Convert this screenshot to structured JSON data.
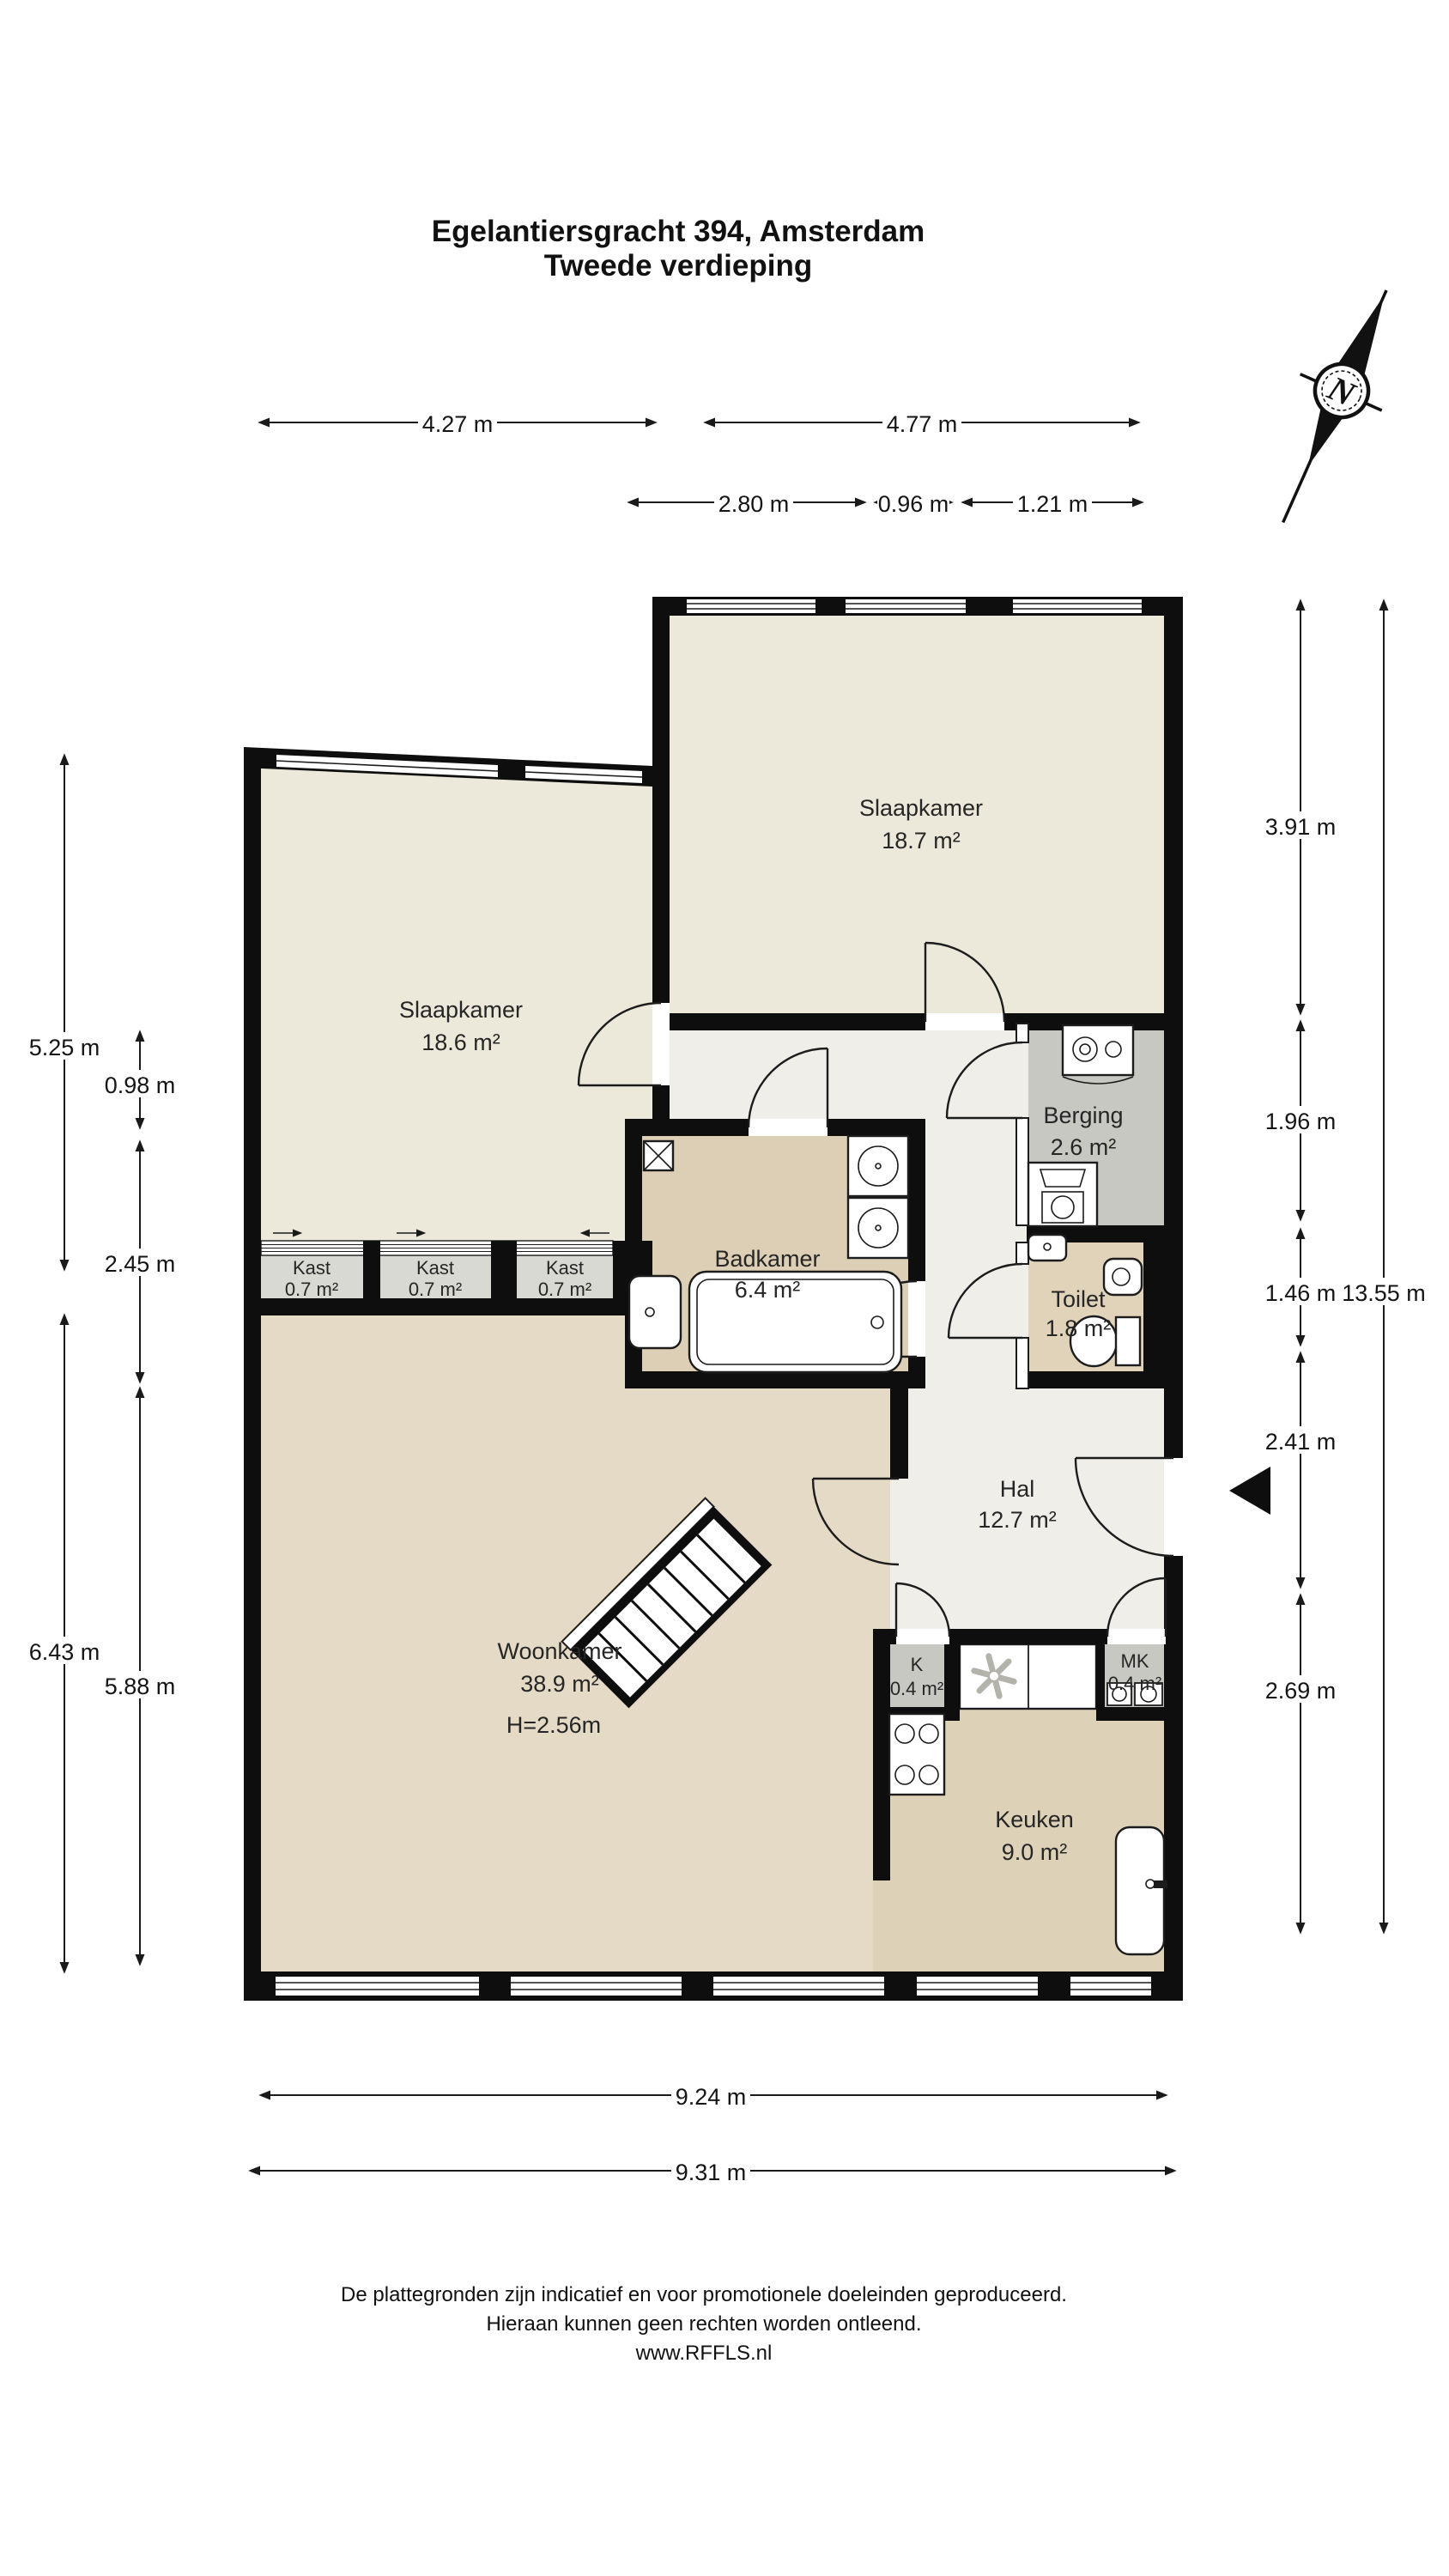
{
  "title": {
    "line1": "Egelantiersgracht 394, Amsterdam",
    "line2": "Tweede verdieping"
  },
  "compass": {
    "label": "N"
  },
  "rooms": [
    {
      "name": "Slaapkamer",
      "area": "18.7 m²"
    },
    {
      "name": "Slaapkamer",
      "area": "18.6 m²"
    },
    {
      "name": "Berging",
      "area": "2.6 m²"
    },
    {
      "name": "Kast",
      "area": "0.7 m²"
    },
    {
      "name": "Kast",
      "area": "0.7 m²"
    },
    {
      "name": "Kast",
      "area": "0.7 m²"
    },
    {
      "name": "Badkamer",
      "area": "6.4 m²"
    },
    {
      "name": "Toilet",
      "area": "1.8 m²"
    },
    {
      "name": "Hal",
      "area": "12.7 m²"
    },
    {
      "name": "Woonkamer",
      "area": "38.9 m²",
      "height_note": "H=2.56m"
    },
    {
      "name": "K",
      "area": "0.4 m²"
    },
    {
      "name": "MK",
      "area": "0.4 m²"
    },
    {
      "name": "Keuken",
      "area": "9.0 m²"
    }
  ],
  "dims": {
    "top": [
      "4.27 m",
      "4.77 m"
    ],
    "top_inner": [
      "2.80 m",
      "0.96 m",
      "1.21 m"
    ],
    "left_outer": [
      "5.25 m",
      "6.43 m"
    ],
    "left_inner": [
      "0.98 m",
      "2.45 m",
      "5.88 m"
    ],
    "right_inner": [
      "3.91 m",
      "1.96 m",
      "1.46 m",
      "2.41 m",
      "2.69 m"
    ],
    "right_outer": "13.55 m",
    "bottom": [
      "9.24 m",
      "9.31 m"
    ]
  },
  "colors": {
    "wall": "#0e0e0e",
    "bedroom_floor": "#ece8da",
    "hall_floor": "#efeee9",
    "bath_floor": "#dccfb5",
    "toilet_floor": "#e0d3ba",
    "living_floor": "#e5dac5",
    "kitchen_floor": "#ddd1b8",
    "storage_floor": "#c6c8c1",
    "closet_floor": "#d7d9d2"
  },
  "footer": {
    "line1": "De plattegronden zijn indicatief en voor promotionele doeleinden geproduceerd.",
    "line2": "Hieraan kunnen geen rechten worden ontleend.",
    "line3": "www.RFFLS.nl"
  }
}
